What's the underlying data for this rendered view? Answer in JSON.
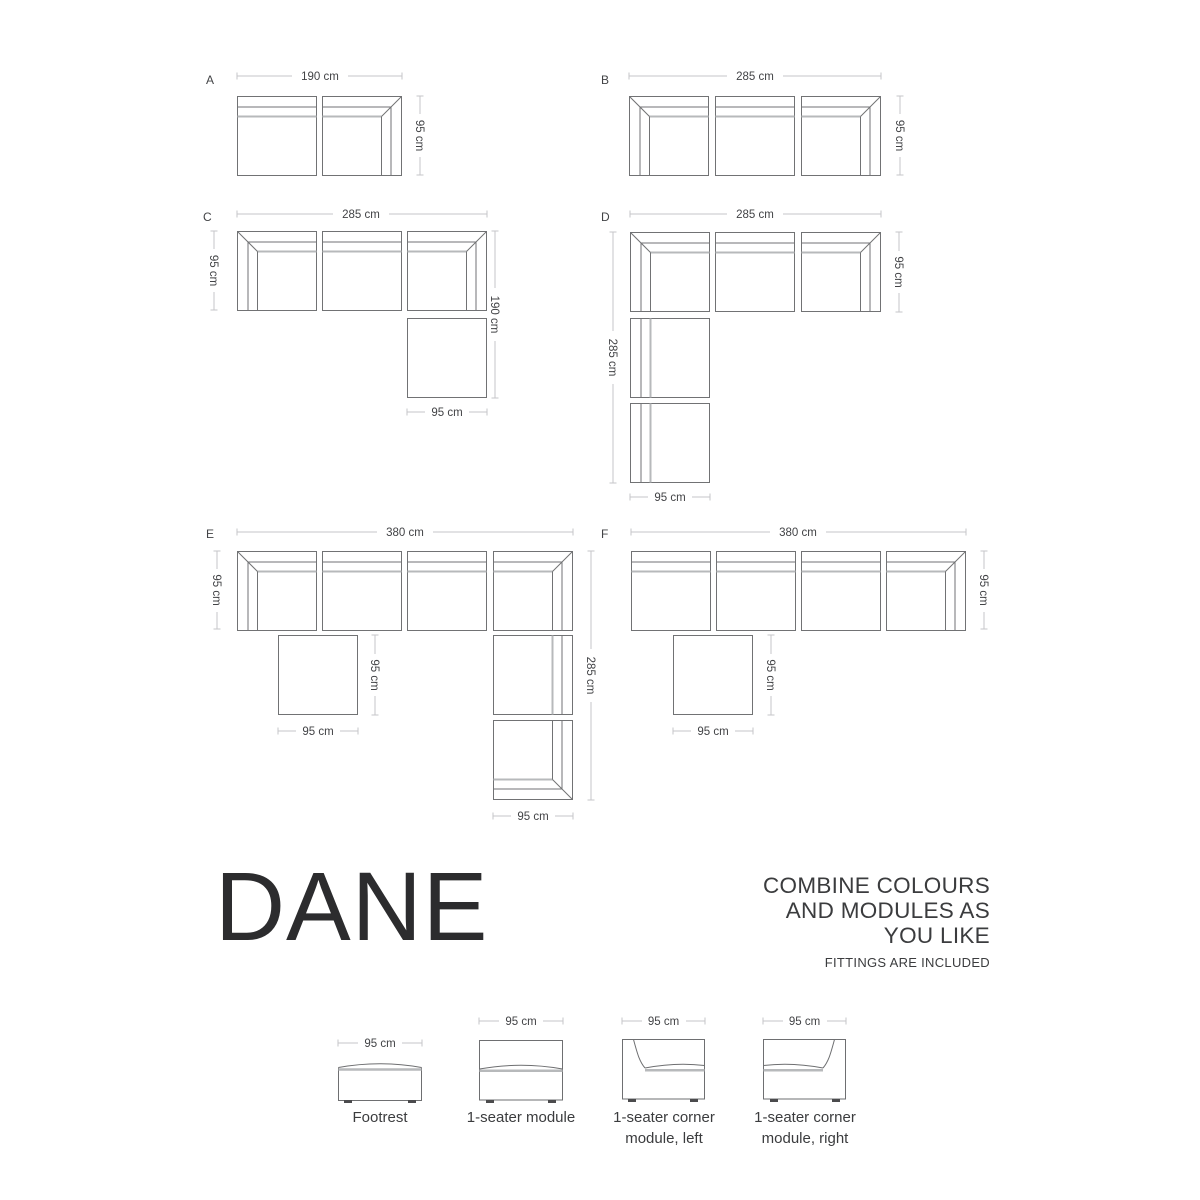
{
  "title": "DANE",
  "tagline": {
    "line1": "COMBINE COLOURS",
    "line2": "AND MODULES AS",
    "line3": "YOU LIKE",
    "note": "FITTINGS ARE INCLUDED"
  },
  "configs": {
    "a": {
      "label": "A",
      "top": "190 cm",
      "right": "95 cm"
    },
    "b": {
      "label": "B",
      "top": "285 cm",
      "right": "95 cm"
    },
    "c": {
      "label": "C",
      "top": "285 cm",
      "left": "95 cm",
      "right": "190 cm",
      "bottom": "95 cm"
    },
    "d": {
      "label": "D",
      "top": "285 cm",
      "right": "95 cm",
      "left": "285 cm",
      "bottom": "95 cm"
    },
    "e": {
      "label": "E",
      "top": "380 cm",
      "left": "95 cm",
      "mid_v": "95 cm",
      "mid_h": "95 cm",
      "right": "285 cm",
      "bottom": "95 cm"
    },
    "f": {
      "label": "F",
      "top": "380 cm",
      "right": "95 cm",
      "mid_v": "95 cm",
      "mid_h": "95 cm"
    }
  },
  "legend": {
    "items": [
      {
        "dim": "95 cm",
        "lines": [
          "Footrest"
        ]
      },
      {
        "dim": "95 cm",
        "lines": [
          "1-seater module"
        ]
      },
      {
        "dim": "95 cm",
        "lines": [
          "1-seater corner",
          "module, left"
        ]
      },
      {
        "dim": "95 cm",
        "lines": [
          "1-seater corner",
          "module, right"
        ]
      }
    ]
  },
  "colors": {
    "module_line": "#717274",
    "seat_line": "#b7b9bb",
    "dimension_line": "#c5c6c8",
    "text": "#424346",
    "title": "#2c2c2e",
    "background": "#ffffff"
  }
}
